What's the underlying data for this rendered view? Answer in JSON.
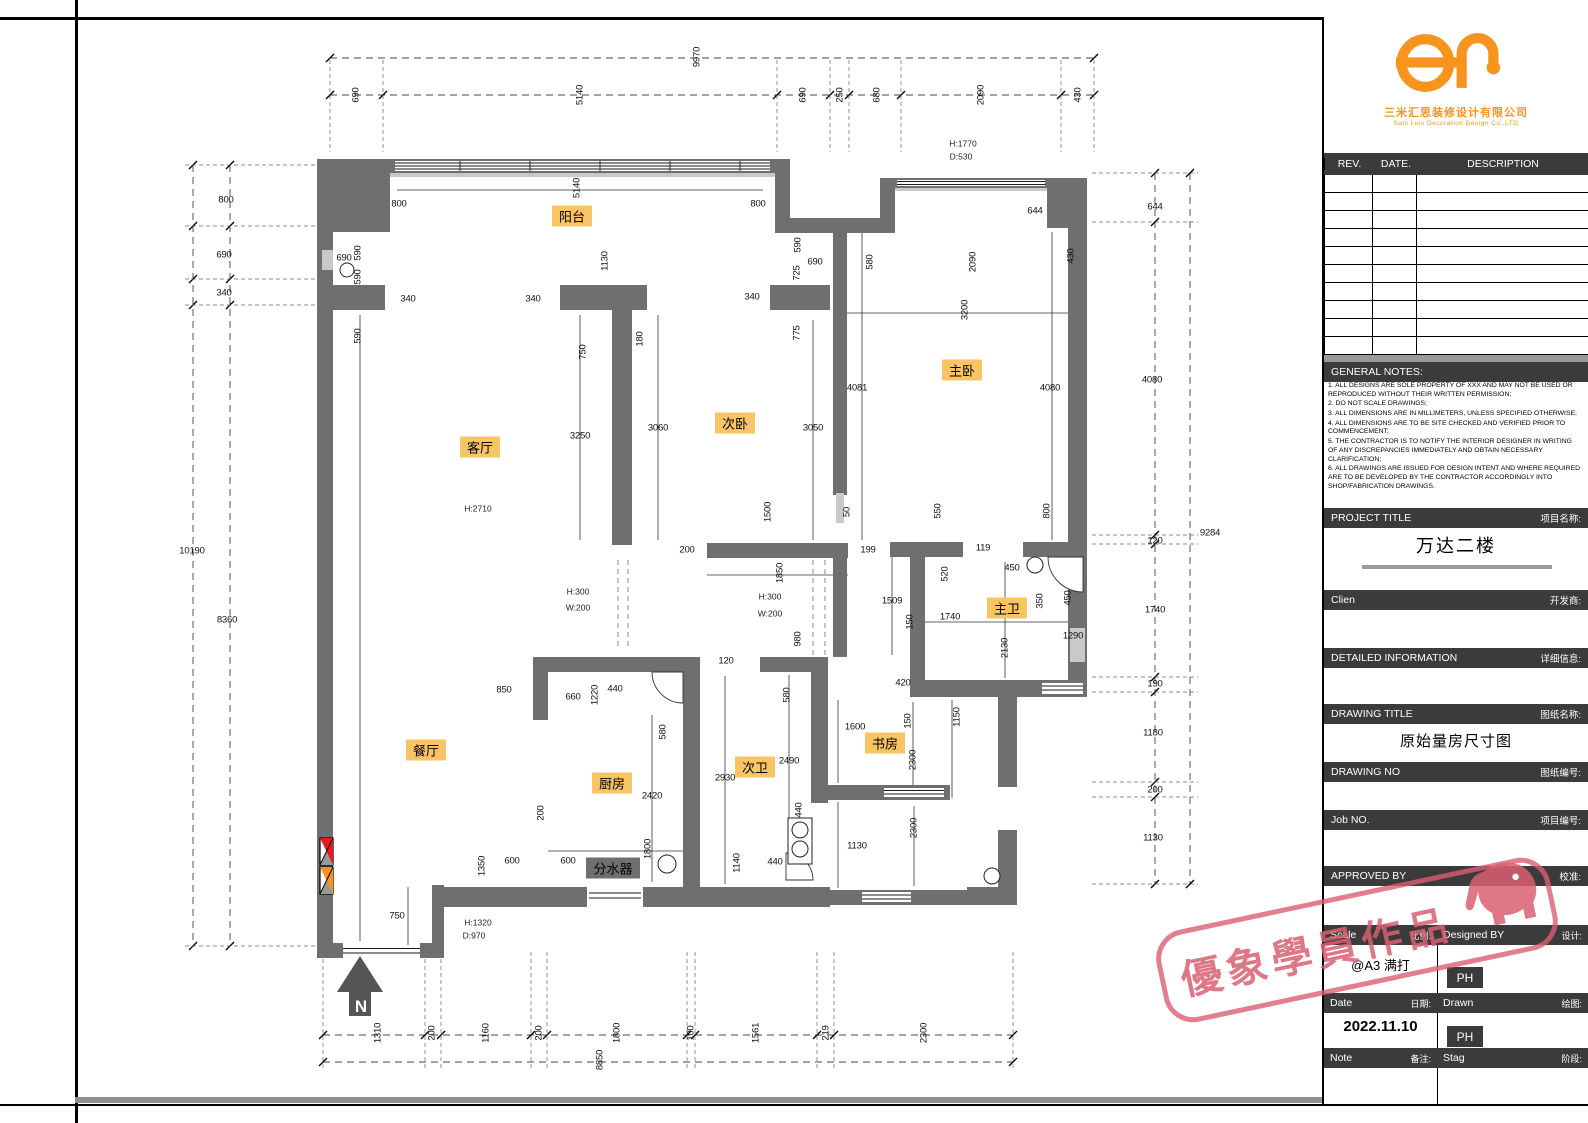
{
  "colors": {
    "wall": "#6f6f6f",
    "label_bg": "#f9c464",
    "dark_bar": "#3b3b3b",
    "orange": "#f7941d",
    "stamp_pink": "#d95f72",
    "legend_red": "#e81c1c",
    "legend_orange": "#f7941d"
  },
  "plan": {
    "north_label": "N",
    "rooms": [
      {
        "t": "阳台",
        "x": 572,
        "y": 216
      },
      {
        "t": "客厅",
        "x": 480,
        "y": 447
      },
      {
        "t": "次卧",
        "x": 735,
        "y": 423
      },
      {
        "t": "主卧",
        "x": 962,
        "y": 370
      },
      {
        "t": "餐厅",
        "x": 426,
        "y": 750
      },
      {
        "t": "厨房",
        "x": 612,
        "y": 783
      },
      {
        "t": "次卫",
        "x": 755,
        "y": 767
      },
      {
        "t": "主卫",
        "x": 1007,
        "y": 608
      },
      {
        "t": "书房",
        "x": 885,
        "y": 743
      },
      {
        "t": "分水器",
        "x": 613,
        "y": 868,
        "dark": true
      }
    ],
    "notes": [
      {
        "t": "H:2710",
        "x": 478,
        "y": 509
      },
      {
        "t": "H:1770",
        "x": 963,
        "y": 144
      },
      {
        "t": "D:530",
        "x": 961,
        "y": 157
      },
      {
        "t": "H:300",
        "x": 578,
        "y": 592
      },
      {
        "t": "W:200",
        "x": 578,
        "y": 608
      },
      {
        "t": "H:300",
        "x": 770,
        "y": 597
      },
      {
        "t": "W:200",
        "x": 770,
        "y": 614
      },
      {
        "t": "H:1320",
        "x": 478,
        "y": 923
      },
      {
        "t": "D:970",
        "x": 474,
        "y": 936
      }
    ],
    "dims": [
      {
        "t": "9970",
        "x": 697,
        "y": 57,
        "r": 1
      },
      {
        "t": "690",
        "x": 356,
        "y": 95,
        "r": 1
      },
      {
        "t": "5140",
        "x": 580,
        "y": 95,
        "r": 1
      },
      {
        "t": "690",
        "x": 803,
        "y": 95,
        "r": 1
      },
      {
        "t": "250",
        "x": 840,
        "y": 95,
        "r": 1
      },
      {
        "t": "680",
        "x": 877,
        "y": 95,
        "r": 1
      },
      {
        "t": "2090",
        "x": 981,
        "y": 95,
        "r": 1
      },
      {
        "t": "430",
        "x": 1078,
        "y": 95,
        "r": 1
      },
      {
        "t": "10190",
        "x": 192,
        "y": 551
      },
      {
        "t": "800",
        "x": 226,
        "y": 200
      },
      {
        "t": "690",
        "x": 224,
        "y": 255
      },
      {
        "t": "340",
        "x": 224,
        "y": 293
      },
      {
        "t": "8360",
        "x": 227,
        "y": 620
      },
      {
        "t": "644",
        "x": 1155,
        "y": 207
      },
      {
        "t": "4080",
        "x": 1152,
        "y": 380
      },
      {
        "t": "120",
        "x": 1155,
        "y": 541
      },
      {
        "t": "1740",
        "x": 1155,
        "y": 610
      },
      {
        "t": "190",
        "x": 1155,
        "y": 684
      },
      {
        "t": "1180",
        "x": 1153,
        "y": 733
      },
      {
        "t": "200",
        "x": 1155,
        "y": 790
      },
      {
        "t": "1130",
        "x": 1153,
        "y": 838
      },
      {
        "t": "9284",
        "x": 1210,
        "y": 533
      },
      {
        "t": "1310",
        "x": 378,
        "y": 1033,
        "r": 1
      },
      {
        "t": "200",
        "x": 432,
        "y": 1033,
        "r": 1
      },
      {
        "t": "1160",
        "x": 486,
        "y": 1033,
        "r": 1
      },
      {
        "t": "200",
        "x": 539,
        "y": 1033,
        "r": 1
      },
      {
        "t": "1800",
        "x": 617,
        "y": 1033,
        "r": 1
      },
      {
        "t": "100",
        "x": 691,
        "y": 1033,
        "r": 1
      },
      {
        "t": "1561",
        "x": 756,
        "y": 1033,
        "r": 1
      },
      {
        "t": "219",
        "x": 826,
        "y": 1033,
        "r": 1
      },
      {
        "t": "2300",
        "x": 924,
        "y": 1033,
        "r": 1
      },
      {
        "t": "8850",
        "x": 600,
        "y": 1060,
        "r": 1
      },
      {
        "t": "5140",
        "x": 577,
        "y": 188,
        "r": 1
      },
      {
        "t": "800",
        "x": 399,
        "y": 204
      },
      {
        "t": "800",
        "x": 758,
        "y": 204
      },
      {
        "t": "690",
        "x": 344,
        "y": 258
      },
      {
        "t": "590",
        "x": 358,
        "y": 253,
        "r": 1
      },
      {
        "t": "590",
        "x": 358,
        "y": 277,
        "r": 1
      },
      {
        "t": "590",
        "x": 358,
        "y": 336,
        "r": 1
      },
      {
        "t": "340",
        "x": 408,
        "y": 299
      },
      {
        "t": "340",
        "x": 533,
        "y": 299
      },
      {
        "t": "340",
        "x": 752,
        "y": 297
      },
      {
        "t": "1130",
        "x": 605,
        "y": 261,
        "r": 1
      },
      {
        "t": "750",
        "x": 583,
        "y": 352,
        "r": 1
      },
      {
        "t": "180",
        "x": 640,
        "y": 339,
        "r": 1
      },
      {
        "t": "3250",
        "x": 580,
        "y": 436
      },
      {
        "t": "3060",
        "x": 658,
        "y": 428
      },
      {
        "t": "3050",
        "x": 813,
        "y": 428
      },
      {
        "t": "4081",
        "x": 857,
        "y": 388
      },
      {
        "t": "4080",
        "x": 1050,
        "y": 388
      },
      {
        "t": "590",
        "x": 798,
        "y": 245,
        "r": 1
      },
      {
        "t": "690",
        "x": 815,
        "y": 262
      },
      {
        "t": "725",
        "x": 797,
        "y": 273,
        "r": 1
      },
      {
        "t": "775",
        "x": 797,
        "y": 333,
        "r": 1
      },
      {
        "t": "644",
        "x": 1035,
        "y": 211
      },
      {
        "t": "580",
        "x": 870,
        "y": 262,
        "r": 1
      },
      {
        "t": "2090",
        "x": 973,
        "y": 262,
        "r": 1
      },
      {
        "t": "430",
        "x": 1071,
        "y": 256,
        "r": 1
      },
      {
        "t": "3200",
        "x": 965,
        "y": 310,
        "r": 1
      },
      {
        "t": "1500",
        "x": 768,
        "y": 512,
        "r": 1
      },
      {
        "t": "50",
        "x": 847,
        "y": 512,
        "r": 1
      },
      {
        "t": "200",
        "x": 687,
        "y": 550
      },
      {
        "t": "199",
        "x": 868,
        "y": 550
      },
      {
        "t": "1850",
        "x": 780,
        "y": 573,
        "r": 1
      },
      {
        "t": "980",
        "x": 798,
        "y": 639,
        "r": 1
      },
      {
        "t": "120",
        "x": 726,
        "y": 661
      },
      {
        "t": "550",
        "x": 938,
        "y": 511,
        "r": 1
      },
      {
        "t": "800",
        "x": 1047,
        "y": 511,
        "r": 1
      },
      {
        "t": "119",
        "x": 983,
        "y": 548
      },
      {
        "t": "520",
        "x": 945,
        "y": 574,
        "r": 1
      },
      {
        "t": "450",
        "x": 1012,
        "y": 568
      },
      {
        "t": "1509",
        "x": 892,
        "y": 601
      },
      {
        "t": "150",
        "x": 910,
        "y": 622,
        "r": 1
      },
      {
        "t": "1740",
        "x": 950,
        "y": 617
      },
      {
        "t": "350",
        "x": 1040,
        "y": 601,
        "r": 1
      },
      {
        "t": "450",
        "x": 1068,
        "y": 598,
        "r": 1
      },
      {
        "t": "2130",
        "x": 1005,
        "y": 648,
        "r": 1
      },
      {
        "t": "1290",
        "x": 1073,
        "y": 636
      },
      {
        "t": "420",
        "x": 903,
        "y": 683
      },
      {
        "t": "1150",
        "x": 957,
        "y": 717,
        "r": 1
      },
      {
        "t": "150",
        "x": 908,
        "y": 721,
        "r": 1
      },
      {
        "t": "1600",
        "x": 855,
        "y": 727
      },
      {
        "t": "2300",
        "x": 913,
        "y": 760,
        "r": 1
      },
      {
        "t": "1130",
        "x": 857,
        "y": 846
      },
      {
        "t": "2300",
        "x": 914,
        "y": 828,
        "r": 1
      },
      {
        "t": "850",
        "x": 504,
        "y": 690
      },
      {
        "t": "660",
        "x": 573,
        "y": 697
      },
      {
        "t": "1220",
        "x": 595,
        "y": 695,
        "r": 1
      },
      {
        "t": "440",
        "x": 615,
        "y": 689
      },
      {
        "t": "580",
        "x": 663,
        "y": 732,
        "r": 1
      },
      {
        "t": "2420",
        "x": 652,
        "y": 796
      },
      {
        "t": "2930",
        "x": 725,
        "y": 778
      },
      {
        "t": "2490",
        "x": 789,
        "y": 761
      },
      {
        "t": "580",
        "x": 787,
        "y": 695,
        "r": 1
      },
      {
        "t": "200",
        "x": 541,
        "y": 813,
        "r": 1
      },
      {
        "t": "1350",
        "x": 482,
        "y": 866,
        "r": 1
      },
      {
        "t": "600",
        "x": 512,
        "y": 861
      },
      {
        "t": "600",
        "x": 568,
        "y": 861
      },
      {
        "t": "1800",
        "x": 648,
        "y": 849,
        "r": 1
      },
      {
        "t": "1140",
        "x": 737,
        "y": 863,
        "r": 1
      },
      {
        "t": "440",
        "x": 775,
        "y": 862
      },
      {
        "t": "440",
        "x": 799,
        "y": 810,
        "r": 1
      },
      {
        "t": "750",
        "x": 397,
        "y": 916
      }
    ]
  },
  "titleblock": {
    "logo": {
      "company_cn": "三米汇思装修设计有限公司",
      "company_en": "Sam Luis Decoration Design Co.,LTD"
    },
    "rev_header": {
      "rev": "REV.",
      "date": "DATE.",
      "description": "DESCRIPTION"
    },
    "general_notes_title": "GENERAL NOTES:",
    "notes": [
      "1. ALL DESIGNS ARE SOLE PROPERTY OF XXX AND MAY NOT BE USED OR REPRODUCED WITHOUT THEIR WRITTEN PERMISSION;",
      "2. DO NOT SCALE DRAWINGS;",
      "3. ALL DIMENSIONS ARE IN MILLIMETERS, UNLESS SPECIFIED OTHERWISE;",
      "4. ALL DIMENSIONS ARE TO BE SITE CHECKED AND VERIFIED PRIOR TO COMMENCEMENT;",
      "5. THE CONTRACTOR IS TO NOTIFY THE INTERIOR DESIGNER IN WRITING OF ANY DISCREPANCIES IMMEDIATELY AND OBTAIN NECESSARY CLARIFICATION;",
      "6. ALL DRAWINGS ARE ISSUED FOR DESIGN INTENT AND WHERE REQUIRED ARE TO BE DEVELOPED BY THE CONTRACTOR ACCORDINGLY INTO SHOP/FABRICATION DRAWINGS."
    ],
    "sections": {
      "project_title_en": "PROJECT TITLE",
      "project_title_cn": "项目名称:",
      "project_title_value": "万达二楼",
      "client_en": "Clien",
      "client_cn": "开发商:",
      "detailed_en": "DETAILED INFORMATION",
      "detailed_cn": "详细信息:",
      "drawing_title_en": "DRAWING TITLE",
      "drawing_title_cn": "图纸名称:",
      "drawing_title_value": "原始量房尺寸图",
      "drawing_no_en": "DRAWING NO",
      "drawing_no_cn": "图纸编号:",
      "job_no_en": "Job NO.",
      "job_no_cn": "项目编号:",
      "approved_en": "APPROVED BY",
      "approved_cn": "校准:",
      "scale_en": "Scale",
      "scale_cn": "比例:",
      "designed_en": "Designed BY",
      "designed_cn": "设计:",
      "scale_value": "@A3 满打",
      "designed_value": "PH",
      "date_en": "Date",
      "date_cn": "日期:",
      "drawn_en": "Drawn",
      "drawn_cn": "绘图:",
      "date_value": "2022.11.10",
      "drawn_value": "PH",
      "note_en": "Note",
      "note_cn": "备注:",
      "stage_en": "Stag",
      "stage_cn": "阶段:"
    }
  },
  "watermark": {
    "text": "優象學員作品"
  }
}
